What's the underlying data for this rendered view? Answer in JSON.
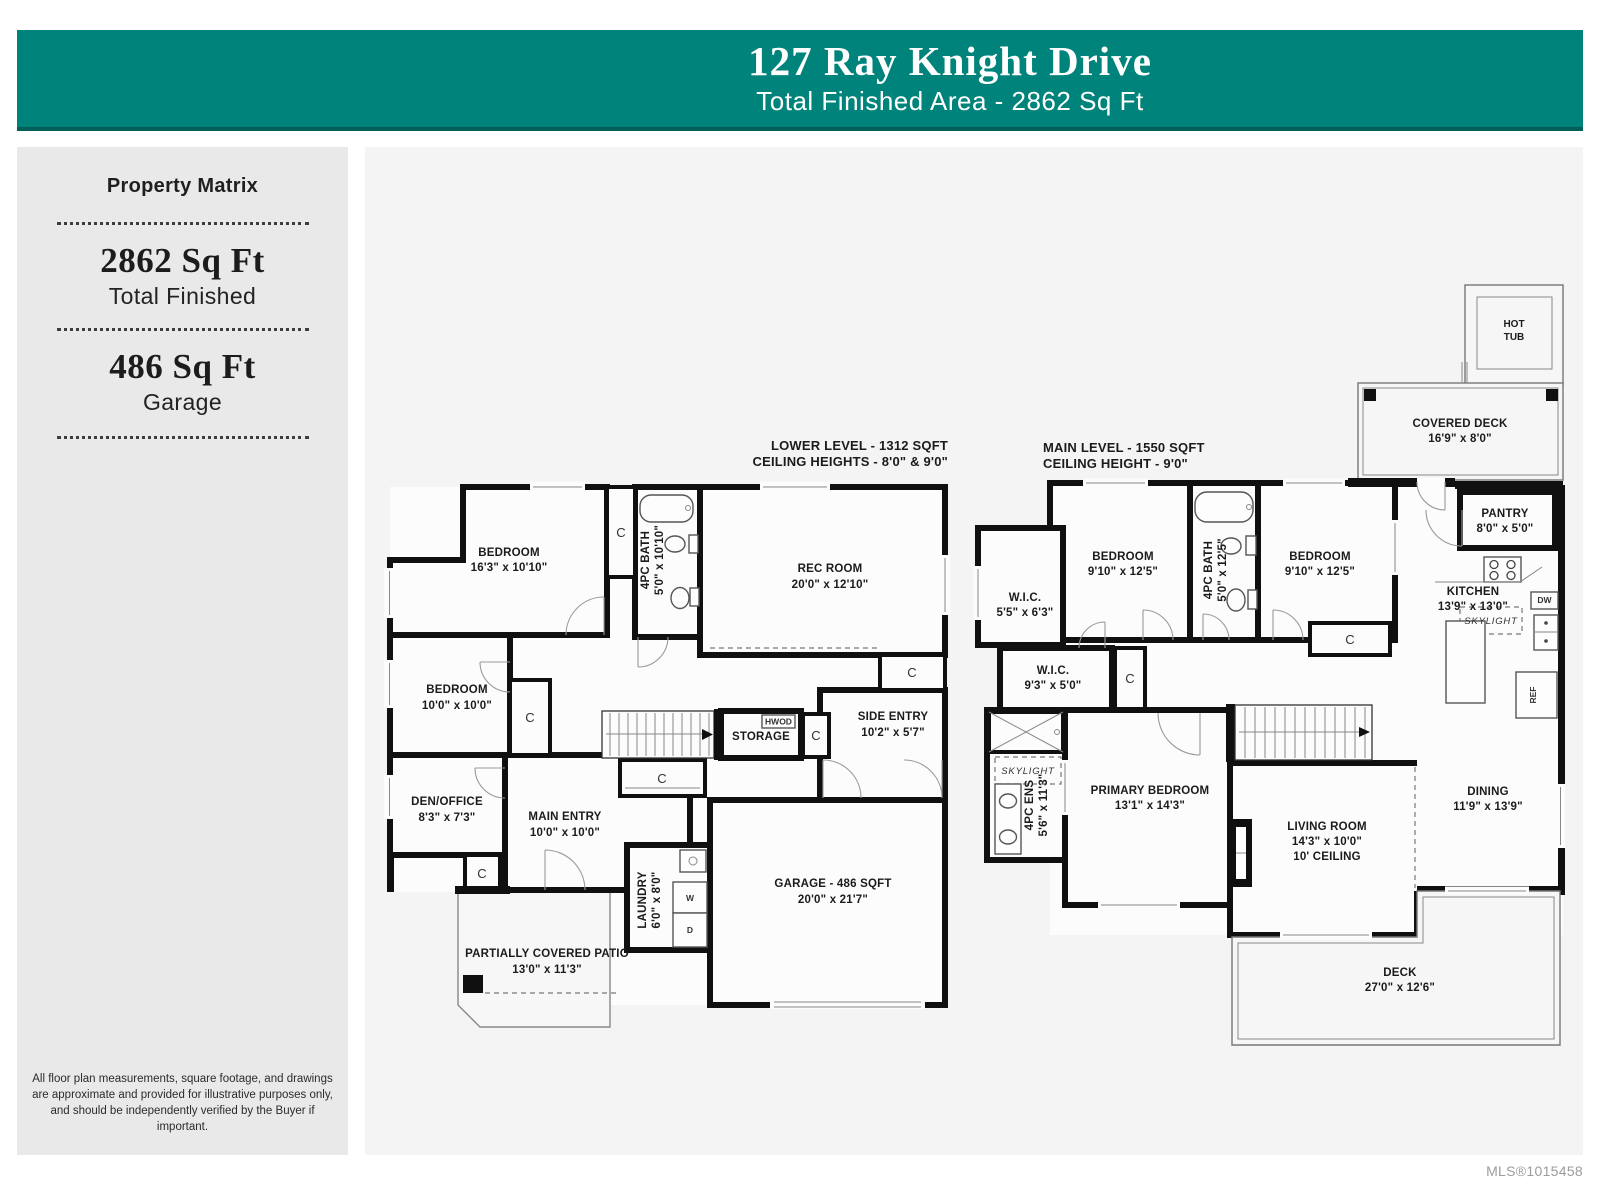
{
  "header": {
    "title": "127 Ray Knight Drive",
    "subtitle": "Total Finished Area - 2862 Sq Ft"
  },
  "sidebar": {
    "title": "Property Matrix",
    "stats": [
      {
        "value": "2862 Sq Ft",
        "label": "Total Finished"
      },
      {
        "value": "486 Sq Ft",
        "label": "Garage"
      }
    ],
    "disclaimer": "All floor plan measurements, square footage, and drawings are approximate and provided for illustrative purposes only, and should be independently verified by the Buyer if important."
  },
  "footer": {
    "mls": "MLS®1015458"
  },
  "colors": {
    "teal": "#00837A",
    "teal_dark": "#015E58",
    "sidebar_bg": "#E9E9E9",
    "plan_bg": "#F4F4F4",
    "wall": "#101010"
  },
  "markers": {
    "closet": "C",
    "skylight": "SKYLIGHT",
    "hwod": "HWOD",
    "washer": "W",
    "dryer": "D",
    "dishwasher": "DW",
    "fridge": "REF",
    "hot_tub_line1": "HOT",
    "hot_tub_line2": "TUB"
  },
  "levels": {
    "lower": {
      "title": "LOWER LEVEL - 1312 SQFT",
      "ceiling": "CEILING HEIGHTS - 8'0\" & 9'0\"",
      "rooms": {
        "bedroom1": {
          "name": "BEDROOM",
          "dims": "16'3\" x 10'10\""
        },
        "bath": {
          "name": "4PC BATH",
          "dims": "5'0\" x 10'10\""
        },
        "rec": {
          "name": "REC ROOM",
          "dims": "20'0\" x 12'10\""
        },
        "bedroom2": {
          "name": "BEDROOM",
          "dims": "10'0\" x 10'0\""
        },
        "den": {
          "name": "DEN/OFFICE",
          "dims": "8'3\" x 7'3\""
        },
        "main_entry": {
          "name": "MAIN ENTRY",
          "dims": "10'0\" x 10'0\""
        },
        "side_entry": {
          "name": "SIDE ENTRY",
          "dims": "10'2\" x 5'7\""
        },
        "storage": {
          "name": "STORAGE"
        },
        "laundry": {
          "name": "LAUNDRY",
          "dims": "6'0\" x 8'0\""
        },
        "garage": {
          "name": "GARAGE - 486 SQFT",
          "dims": "20'0\" x 21'7\""
        },
        "patio": {
          "name": "PARTIALLY COVERED PATIO",
          "dims": "13'0\" x 11'3\""
        }
      }
    },
    "main": {
      "title": "MAIN LEVEL - 1550 SQFT",
      "ceiling": "CEILING HEIGHT - 9'0\"",
      "rooms": {
        "hot_tub": {
          "name": "HOT TUB"
        },
        "covered_deck": {
          "name": "COVERED DECK",
          "dims": "16'9\" x 8'0\""
        },
        "bedroom_l": {
          "name": "BEDROOM",
          "dims": "9'10\" x 12'5\""
        },
        "bath": {
          "name": "4PC BATH",
          "dims": "5'0\" x 12'5\""
        },
        "bedroom_r": {
          "name": "BEDROOM",
          "dims": "9'10\" x 12'5\""
        },
        "wic1": {
          "name": "W.I.C.",
          "dims": "5'5\" x 6'3\""
        },
        "wic2": {
          "name": "W.I.C.",
          "dims": "9'3\" x 5'0\""
        },
        "pantry": {
          "name": "PANTRY",
          "dims": "8'0\" x 5'0\""
        },
        "kitchen": {
          "name": "KITCHEN",
          "dims": "13'9\" x 13'0\""
        },
        "ens": {
          "name": "4PC ENS",
          "dims": "5'6\" x 11'3\""
        },
        "primary": {
          "name": "PRIMARY BEDROOM",
          "dims": "13'1\" x 14'3\""
        },
        "living": {
          "name": "LIVING ROOM",
          "dims": "14'3\" x 10'0\"",
          "note": "10' CEILING"
        },
        "dining": {
          "name": "DINING",
          "dims": "11'9\" x 13'9\""
        },
        "deck": {
          "name": "DECK",
          "dims": "27'0\" x 12'6\""
        }
      }
    }
  }
}
